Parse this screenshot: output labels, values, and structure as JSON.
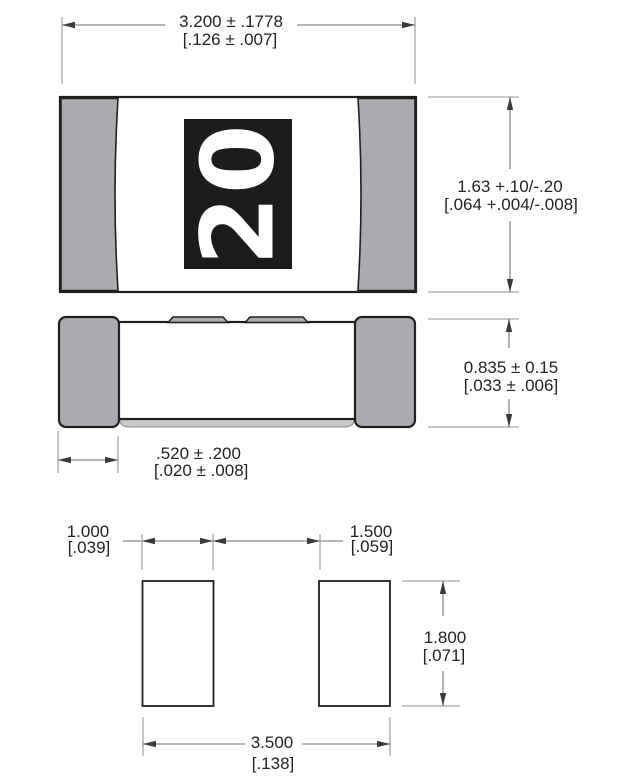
{
  "marking": {
    "label": "20",
    "text_color": "#ffffff",
    "background": "#1d1b1b"
  },
  "colors": {
    "terminal_gray": "#a9abae",
    "outline": "#231f20",
    "dimension_line": "#87898c",
    "extension_line": "#a4a6a9",
    "background": "#ffffff"
  },
  "dimensions": {
    "body_length": {
      "metric": "3.200 ± .1778",
      "inch": "[.126 ± .007]"
    },
    "body_width": {
      "metric": "1.63 +.10/-.20",
      "inch": "[.064 +.004/-.008]"
    },
    "body_height": {
      "metric": "0.835 ± 0.15",
      "inch": "[.033 ± .006]"
    },
    "terminal_length": {
      "metric": ".520 ± .200",
      "inch": "[.020 ± .008]"
    },
    "pad_width": {
      "metric": "1.000",
      "inch": "[.039]"
    },
    "pad_gap": {
      "metric": "1.500",
      "inch": "[.059]"
    },
    "pad_height": {
      "metric": "1.800",
      "inch": "[.071]"
    },
    "pad_span": {
      "metric": "3.500",
      "inch": "[.138]"
    }
  }
}
